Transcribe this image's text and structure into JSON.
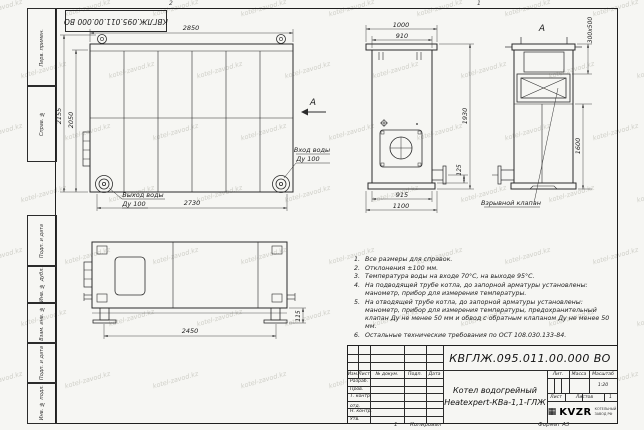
{
  "watermark": {
    "text": "kotel-zavod.kz"
  },
  "frame": {
    "left_labels": [
      "Перв. примен.",
      "Справ. №",
      "Подп. и дата",
      "Инв. № дубл.",
      "Взам. инв. №",
      "Подп. и дата",
      "Инв. № подл."
    ],
    "zone_top_left": "2",
    "zone_top_right": "1",
    "zone_bottom": "1",
    "copied_label": "Копировал",
    "format_label": "Формат А3"
  },
  "stamp_flipped": "КВГЛЖ.095.011.00.000 ВО",
  "views": {
    "side": {
      "dims": {
        "top": "2850",
        "bottom": "2730",
        "outer_h": "2155",
        "inner_h": "2050"
      },
      "view_arrow_label": "А",
      "label_outlet": "Выход воды",
      "label_outlet_dn": "Ду 100",
      "label_inlet": "Вход воды",
      "label_inlet_dn": "Ду 100"
    },
    "front": {
      "dims": {
        "w1": "1000",
        "w2": "910",
        "h": "1930",
        "h2": "125",
        "b1": "915",
        "b2": "1100"
      }
    },
    "viewA": {
      "label": "А",
      "dims": {
        "valve": "300х500",
        "h": "1600"
      },
      "callout": "Взрывной клапан"
    },
    "bottom": {
      "dims": {
        "w": "2450",
        "h": "115"
      }
    }
  },
  "notes": {
    "items": [
      {
        "n": "1.",
        "text": "Все размеры для справок."
      },
      {
        "n": "2.",
        "text": "Отклонения ±100 мм."
      },
      {
        "n": "3.",
        "text": "Температура воды на входе 70°С, на выходе 95°С."
      },
      {
        "n": "4.",
        "text": "На подводящей трубе котла, до запорной арматуры установлены: манометр, прибор для измерения температуры."
      },
      {
        "n": "5.",
        "text": "На отводящей трубе котла, до запорной арматуры установлены: манометр, прибор для измерения температуры, предохранительный клапан Ду не менее 50 мм и обвод с обратным клапаном Ду не менее 50 мм."
      },
      {
        "n": "6.",
        "text": "Остальные технические требования по ОСТ 108.030.133-84."
      }
    ]
  },
  "title_block": {
    "doc_number": "КВГЛЖ.095.011.00.000 ВО",
    "product_name_line1": "Котел водогрейный",
    "product_name_line2": "Heatexpert-КВа-1,1-ГЛЖ",
    "col_izm": "Изм.",
    "col_list": "Лист",
    "col_doc": "№ докум.",
    "col_podp": "Подп.",
    "col_data": "Дата",
    "row_razrab": "Разраб.",
    "row_prov": "Пров.",
    "row_tkontr": "Т. контр.",
    "row_nachotd": "Нач. отд.",
    "row_nkontr": "Н. контр.",
    "row_utv": "Утв.",
    "lit_label": "Лит.",
    "mass_label": "Масса",
    "scale_label": "Масштаб",
    "scale_value": "1:20",
    "sheet_label": "Лист",
    "sheets_label": "Листов",
    "sheets_value": "1",
    "logo_text": "KVZR",
    "logo_sub1": "КОТЕЛЬНЫЙ",
    "logo_sub2": "ЗАВОД РФ"
  },
  "colors": {
    "line": "#2b2b2b",
    "paper": "#f6f6f3",
    "watermark": "#cfcfc8"
  }
}
